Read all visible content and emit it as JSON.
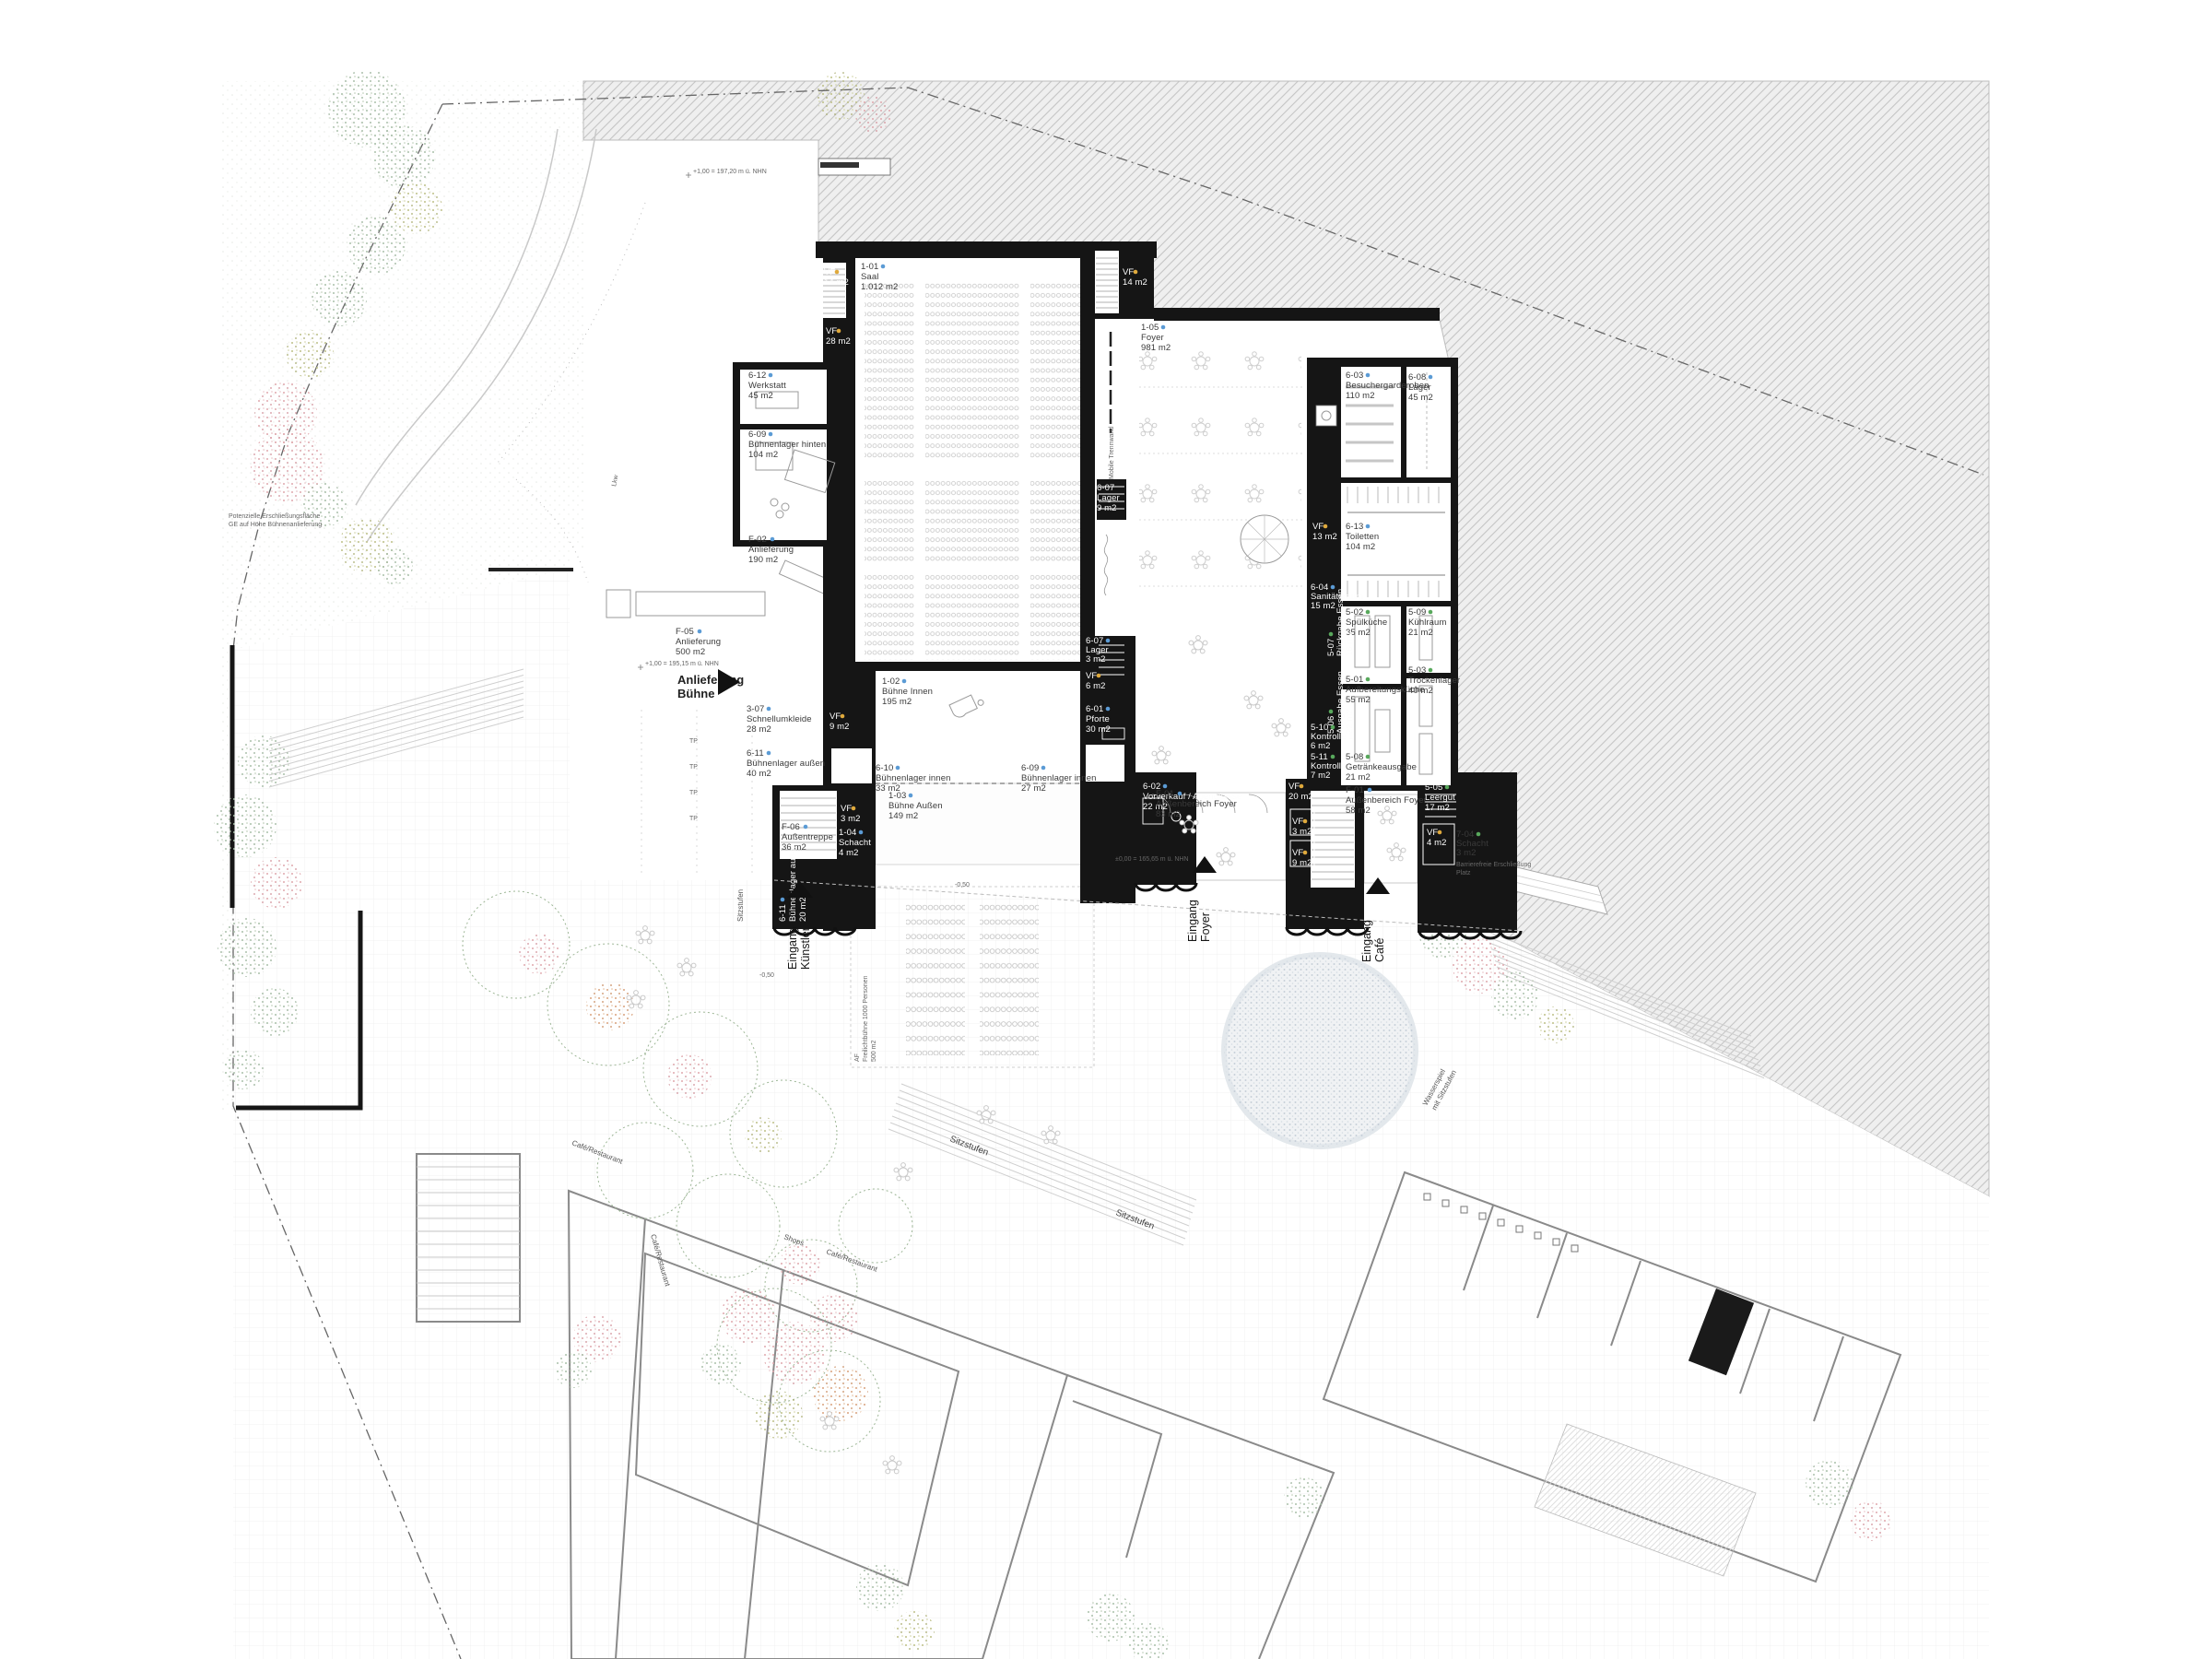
{
  "drawing": {
    "kind": "architectural ground floor / site plan, concert hall with plaza",
    "colors": {
      "wall": "#151515",
      "hatch_line": "#c4c4c4",
      "hatch_bg": "#efefef",
      "outline": "#8a8a8a",
      "seat_stroke": "#c6c6c6",
      "id_dot_blue": "#5b9bd5",
      "id_dot_green": "#58a85c",
      "id_dot_yellow": "#dfa93c",
      "tree_sage": "#a9bfa9",
      "tree_pink": "#dfa8ad",
      "tree_orange": "#d8a27c",
      "tree_olive": "#bdbf86",
      "water_dot": "#c3ccd6"
    }
  },
  "rooms": [
    {
      "id": "1-01",
      "name": "Saal",
      "area": "1.012 m2"
    },
    {
      "id": "1-05",
      "name": "Foyer",
      "area": "981 m2"
    },
    {
      "id": "1-02",
      "name": "Bühne Innen",
      "area": "195 m2"
    },
    {
      "id": "1-03",
      "name": "Bühne Außen",
      "area": "149 m2"
    },
    {
      "id": "1-04",
      "name": "Schacht",
      "area": "4 m2"
    },
    {
      "id": "6-12",
      "name": "Werkstatt",
      "area": "45 m2"
    },
    {
      "id": "6-09",
      "name": "Bühnenlager hinten",
      "area": "104 m2"
    },
    {
      "id": "F-02",
      "name": "Anlieferung",
      "area": "190 m2"
    },
    {
      "id": "F-05",
      "name": "Anlieferung",
      "area": "500 m2"
    },
    {
      "id": "3-07",
      "name": "Schnellumkleide",
      "area": "28 m2"
    },
    {
      "id": "6-11",
      "name": "Bühnenlager außen",
      "area": "40 m2"
    },
    {
      "id": "VF",
      "name": "",
      "area": "9 m2"
    },
    {
      "id": "6-10",
      "name": "Bühnenlager innen",
      "area": "33 m2"
    },
    {
      "id": "6-09",
      "name": "Bühnenlager innen",
      "area": "27 m2"
    },
    {
      "id": "F-06",
      "name": "Außentreppe",
      "area": "36 m2"
    },
    {
      "id": "VF",
      "name": "",
      "area": "3 m2"
    },
    {
      "id": "6-11",
      "name": "Bühnenlager außen",
      "area": "20 m2"
    },
    {
      "id": "VF",
      "name": "",
      "area": "14 m2"
    },
    {
      "id": "VF",
      "name": "",
      "area": "28 m2"
    },
    {
      "id": "VF",
      "name": "",
      "area": "14 m2"
    },
    {
      "id": "6-07",
      "name": "Lager",
      "area": "9 m2"
    },
    {
      "id": "6-07",
      "name": "Lager",
      "area": "3 m2"
    },
    {
      "id": "VF",
      "name": "",
      "area": "6 m2"
    },
    {
      "id": "6-01",
      "name": "Pforte",
      "area": "30 m2"
    },
    {
      "id": "6-02",
      "name": "Vorverkauf / Abendkasse",
      "area": "22 m2"
    },
    {
      "id": "6-03",
      "name": "Besuchergarderoben",
      "area": "110 m2"
    },
    {
      "id": "6-08",
      "name": "Lager",
      "area": "45 m2"
    },
    {
      "id": "VF",
      "name": "",
      "area": "13 m2"
    },
    {
      "id": "6-13",
      "name": "Toiletten",
      "area": "104 m2"
    },
    {
      "id": "6-04",
      "name": "Sanitätsraum",
      "area": "15 m2"
    },
    {
      "id": "5-02",
      "name": "Spülküche",
      "area": "35 m2"
    },
    {
      "id": "5-09",
      "name": "Kühlraum",
      "area": "21 m2"
    },
    {
      "id": "5-07",
      "name": "Rückgabe Essen",
      "area": "16 m2"
    },
    {
      "id": "5-01",
      "name": "Aufbereitungsküche",
      "area": "55 m2"
    },
    {
      "id": "5-03",
      "name": "Trockenlager",
      "area": "40 m2"
    },
    {
      "id": "5-06",
      "name": "Ausgabe Essen",
      "area": "22 m2"
    },
    {
      "id": "5-10",
      "name": "Kontrolle 1",
      "area": "6 m2"
    },
    {
      "id": "5-11",
      "name": "Kontrolle 2",
      "area": "7 m2"
    },
    {
      "id": "5-08",
      "name": "Getränkeausgabe",
      "area": "21 m2"
    },
    {
      "id": "F-01",
      "name": "Außenbereich Foyer",
      "area": "58 m2"
    },
    {
      "id": "5-05",
      "name": "Leergut",
      "area": "17 m2"
    },
    {
      "id": "VF",
      "name": "",
      "area": "20 m2"
    },
    {
      "id": "VF",
      "name": "",
      "area": "3 m2"
    },
    {
      "id": "VF",
      "name": "",
      "area": "9 m2"
    },
    {
      "id": "VF",
      "name": "",
      "area": "4 m2"
    },
    {
      "id": "7-04",
      "name": "Schacht",
      "area": "3 m2"
    },
    {
      "id": "F-01",
      "name": "Außenbereich Foyer",
      "area": "83 m2"
    }
  ],
  "annotations": {
    "anlieferung_buehne": [
      "Anlieferung",
      "Bühne"
    ],
    "eingang_kuenstler": [
      "Eingang",
      "Künstler"
    ],
    "eingang_foyer": [
      "Eingang",
      "Foyer"
    ],
    "eingang_cafe": [
      "Eingang",
      "Café"
    ],
    "sitzstufen": "Sitzstufen",
    "wasserspiel": [
      "Wasserspiel",
      "mit Sitzstufen"
    ],
    "freilichtbuehne": [
      "AF",
      "Freilichtbühne 1000 Personen",
      "500 m2"
    ],
    "barrierefrei": [
      "Barrierefreie Erschließung",
      "Platz"
    ],
    "cafe_restaurant": "Café/Restaurant",
    "shops": "Shops",
    "mobile_trennwand": "Mobile Trennwand",
    "tp": "TP",
    "lkw": "Lkw",
    "potenzielle": [
      "Potenzielle Erschließungsfläche",
      "GE auf Höhe Bühnenanlieferung"
    ],
    "elev_top": "+1,00 = 197,20 m ü. NHN",
    "elev_yard": "+1,00 = 195,15 m ü. NHN",
    "elev_plaza": "±0,00 = 165,65 m ü. NHN",
    "elev_minus_050": "-0,50"
  }
}
